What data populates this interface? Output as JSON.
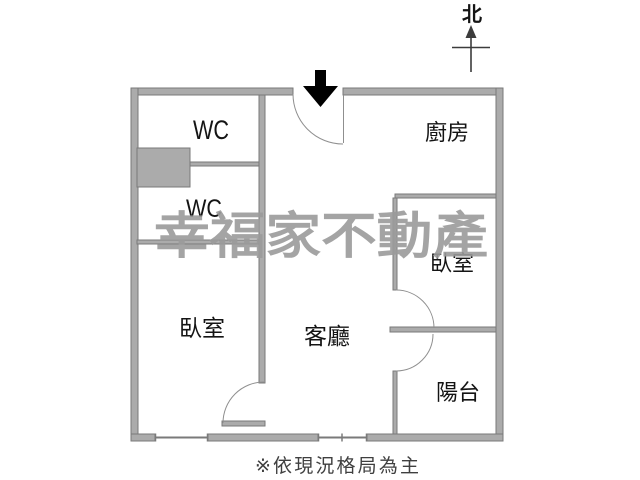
{
  "rooms": {
    "wc_top": "WC",
    "wc_bottom": "WC",
    "kitchen": "廚房",
    "bedroom_right": "臥室",
    "bedroom_left": "臥室",
    "living_room": "客廳",
    "balcony": "陽台"
  },
  "compass": {
    "north_label": "北"
  },
  "watermark_text": "幸福家不動產",
  "caption": "※依現況格局為主",
  "colors": {
    "wall_fill": "#ababab",
    "wall_border": "#7a7a7a",
    "door_arc": "#8f8f8f",
    "arrow": "#000000",
    "compass": "#3c3c3c",
    "text": "#141414",
    "watermark": "#9b9b9b",
    "caption": "#3f3f3f"
  }
}
